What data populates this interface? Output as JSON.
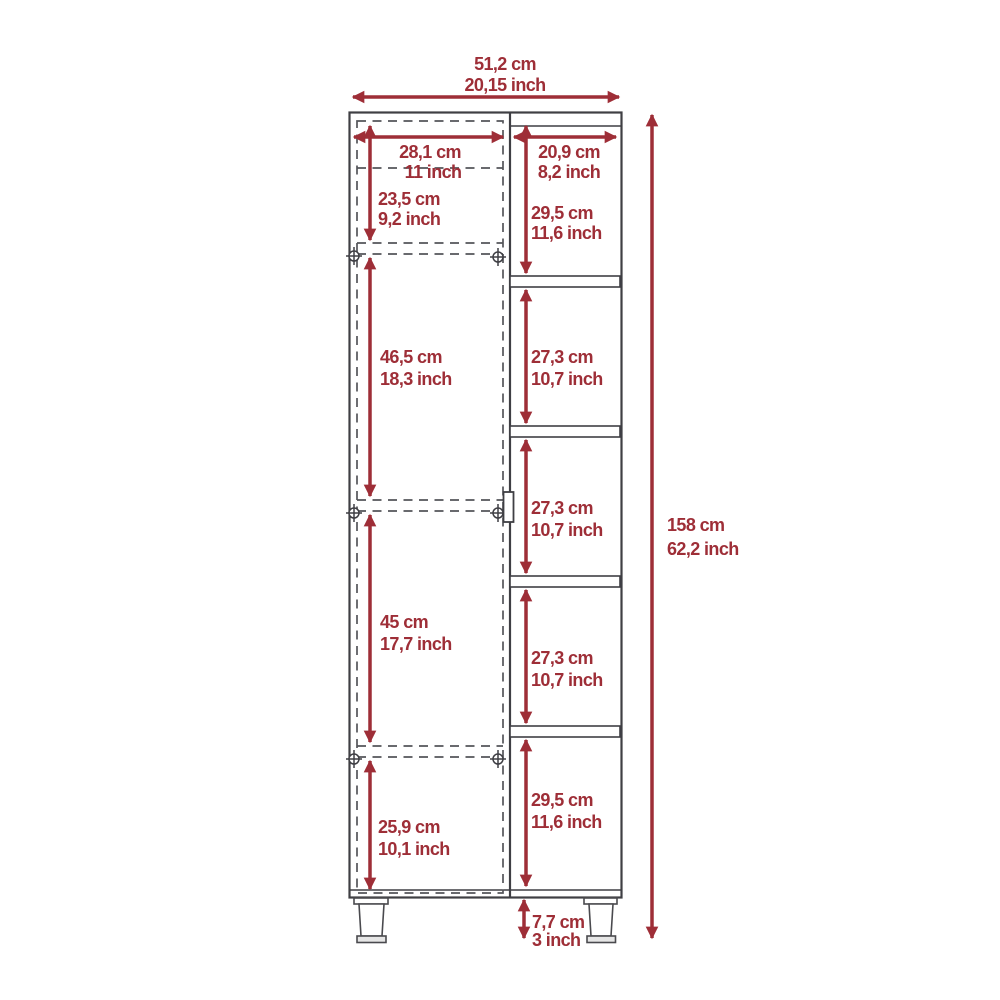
{
  "diagram": {
    "kind": "furniture dimension drawing, tall cabinet with side shelves, front elevation",
    "colors": {
      "dimension_accent": "#9e2e37",
      "outline": "#3f3f44",
      "hidden_line": "#54555a",
      "background": "#ffffff"
    },
    "dimensions": {
      "overall_width": {
        "cm": "51,2 cm",
        "inch": "20,15 inch"
      },
      "overall_height": {
        "cm": "158 cm",
        "inch": "62,2 inch"
      },
      "door_width": {
        "cm": "28,1 cm",
        "inch": "11 inch"
      },
      "shelf_column_width": {
        "cm": "20,9 cm",
        "inch": "8,2 inch"
      },
      "door_section_top": {
        "cm": "23,5 cm",
        "inch": "9,2 inch"
      },
      "door_section_upper": {
        "cm": "46,5 cm",
        "inch": "18,3 inch"
      },
      "door_section_lower": {
        "cm": "45 cm",
        "inch": "17,7 inch"
      },
      "door_section_bottom": {
        "cm": "25,9 cm",
        "inch": "10,1 inch"
      },
      "shelf_1": {
        "cm": "29,5 cm",
        "inch": "11,6 inch"
      },
      "shelf_2": {
        "cm": "27,3 cm",
        "inch": "10,7 inch"
      },
      "shelf_3": {
        "cm": "27,3 cm",
        "inch": "10,7 inch"
      },
      "shelf_4": {
        "cm": "27,3 cm",
        "inch": "10,7 inch"
      },
      "shelf_5": {
        "cm": "29,5 cm",
        "inch": "11,6 inch"
      },
      "leg_height": {
        "cm": "7,7 cm",
        "inch": "3 inch"
      }
    }
  }
}
